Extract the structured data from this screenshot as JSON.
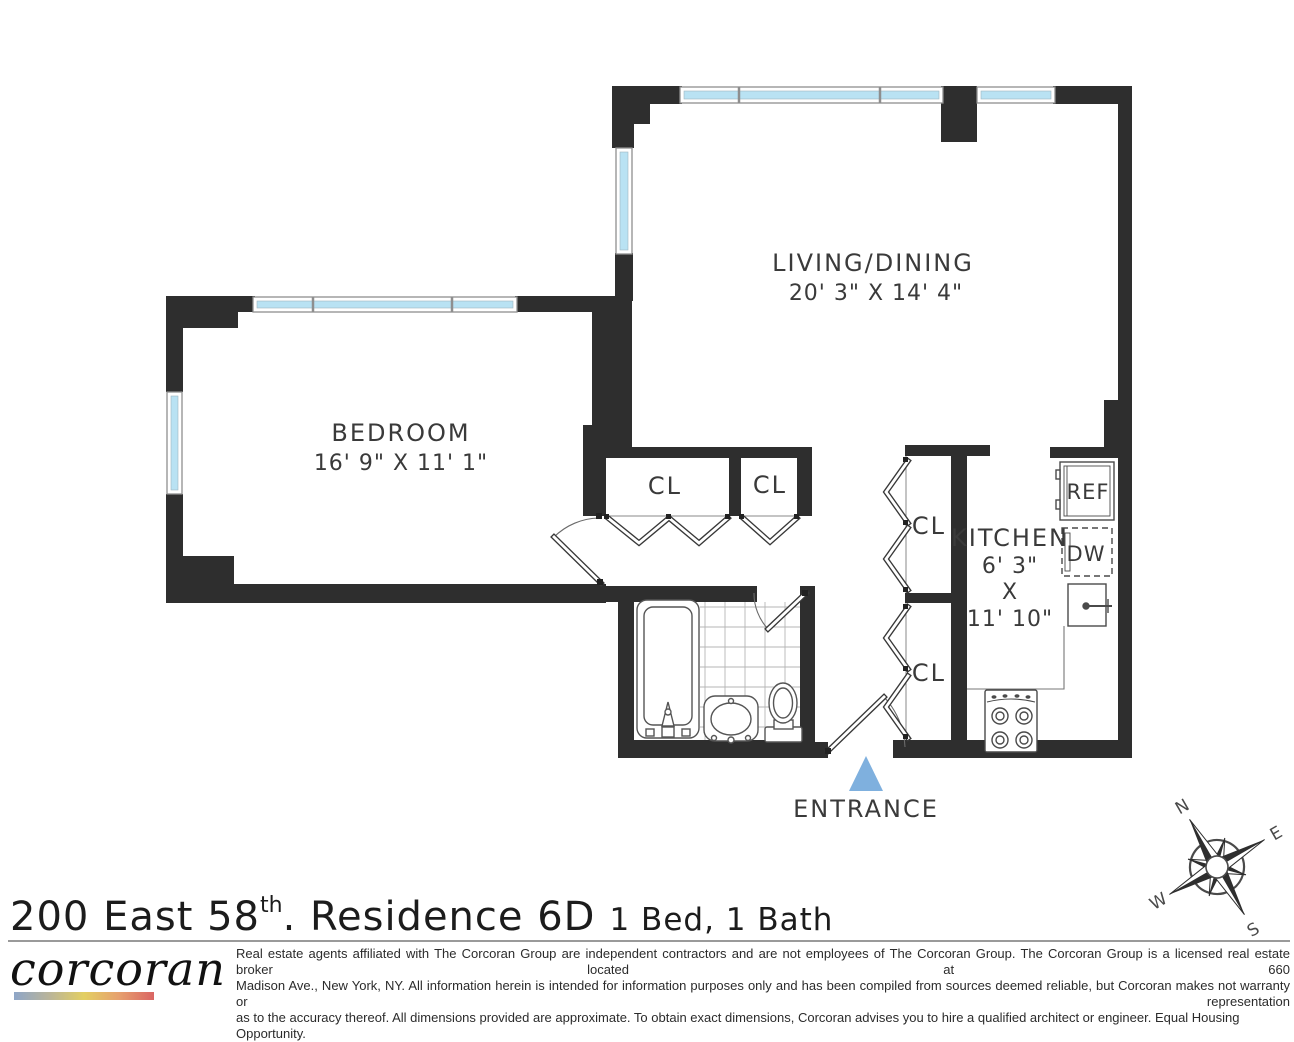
{
  "plan": {
    "rooms": {
      "living_name": "LIVING/DINING",
      "living_dims": "20' 3\" X 14' 4\"",
      "bedroom_name": "BEDROOM",
      "bedroom_dims": "16' 9\" X 11' 1\"",
      "kitchen_name": "KITCHEN",
      "kitchen_dim_w": "6' 3\"",
      "kitchen_dim_x": "X",
      "kitchen_dim_h": "11' 10\"",
      "closet": "CL",
      "fridge": "REF",
      "dishwasher": "DW",
      "entrance": "ENTRANCE"
    },
    "compass": {
      "n": "N",
      "e": "E",
      "s": "S",
      "w": "W"
    },
    "colors": {
      "wall": "#2e2e2e",
      "window_glass": "#b9e2f3",
      "entrance_arrow": "#7fb0de"
    }
  },
  "footer": {
    "title": {
      "address": "200 East 58",
      "superscript": "th",
      "residence": ". Residence 6D",
      "beds_baths": "1 Bed, 1 Bath"
    },
    "brand": "corcoran",
    "disclaimer_lines": [
      "Real estate agents affiliated with The Corcoran Group are independent contractors and are not employees of The Corcoran Group. The Corcoran Group is a licensed real estate broker located at 660",
      "Madison Ave., New York, NY. All information herein is intended for information purposes only and has been compiled from sources deemed reliable, but Corcoran makes not warranty or representation",
      "as to the accuracy thereof. All dimensions provided are approximate. To obtain exact dimensions, Corcoran advises you to hire a qualified architect or engineer. Equal Housing Opportunity."
    ]
  }
}
